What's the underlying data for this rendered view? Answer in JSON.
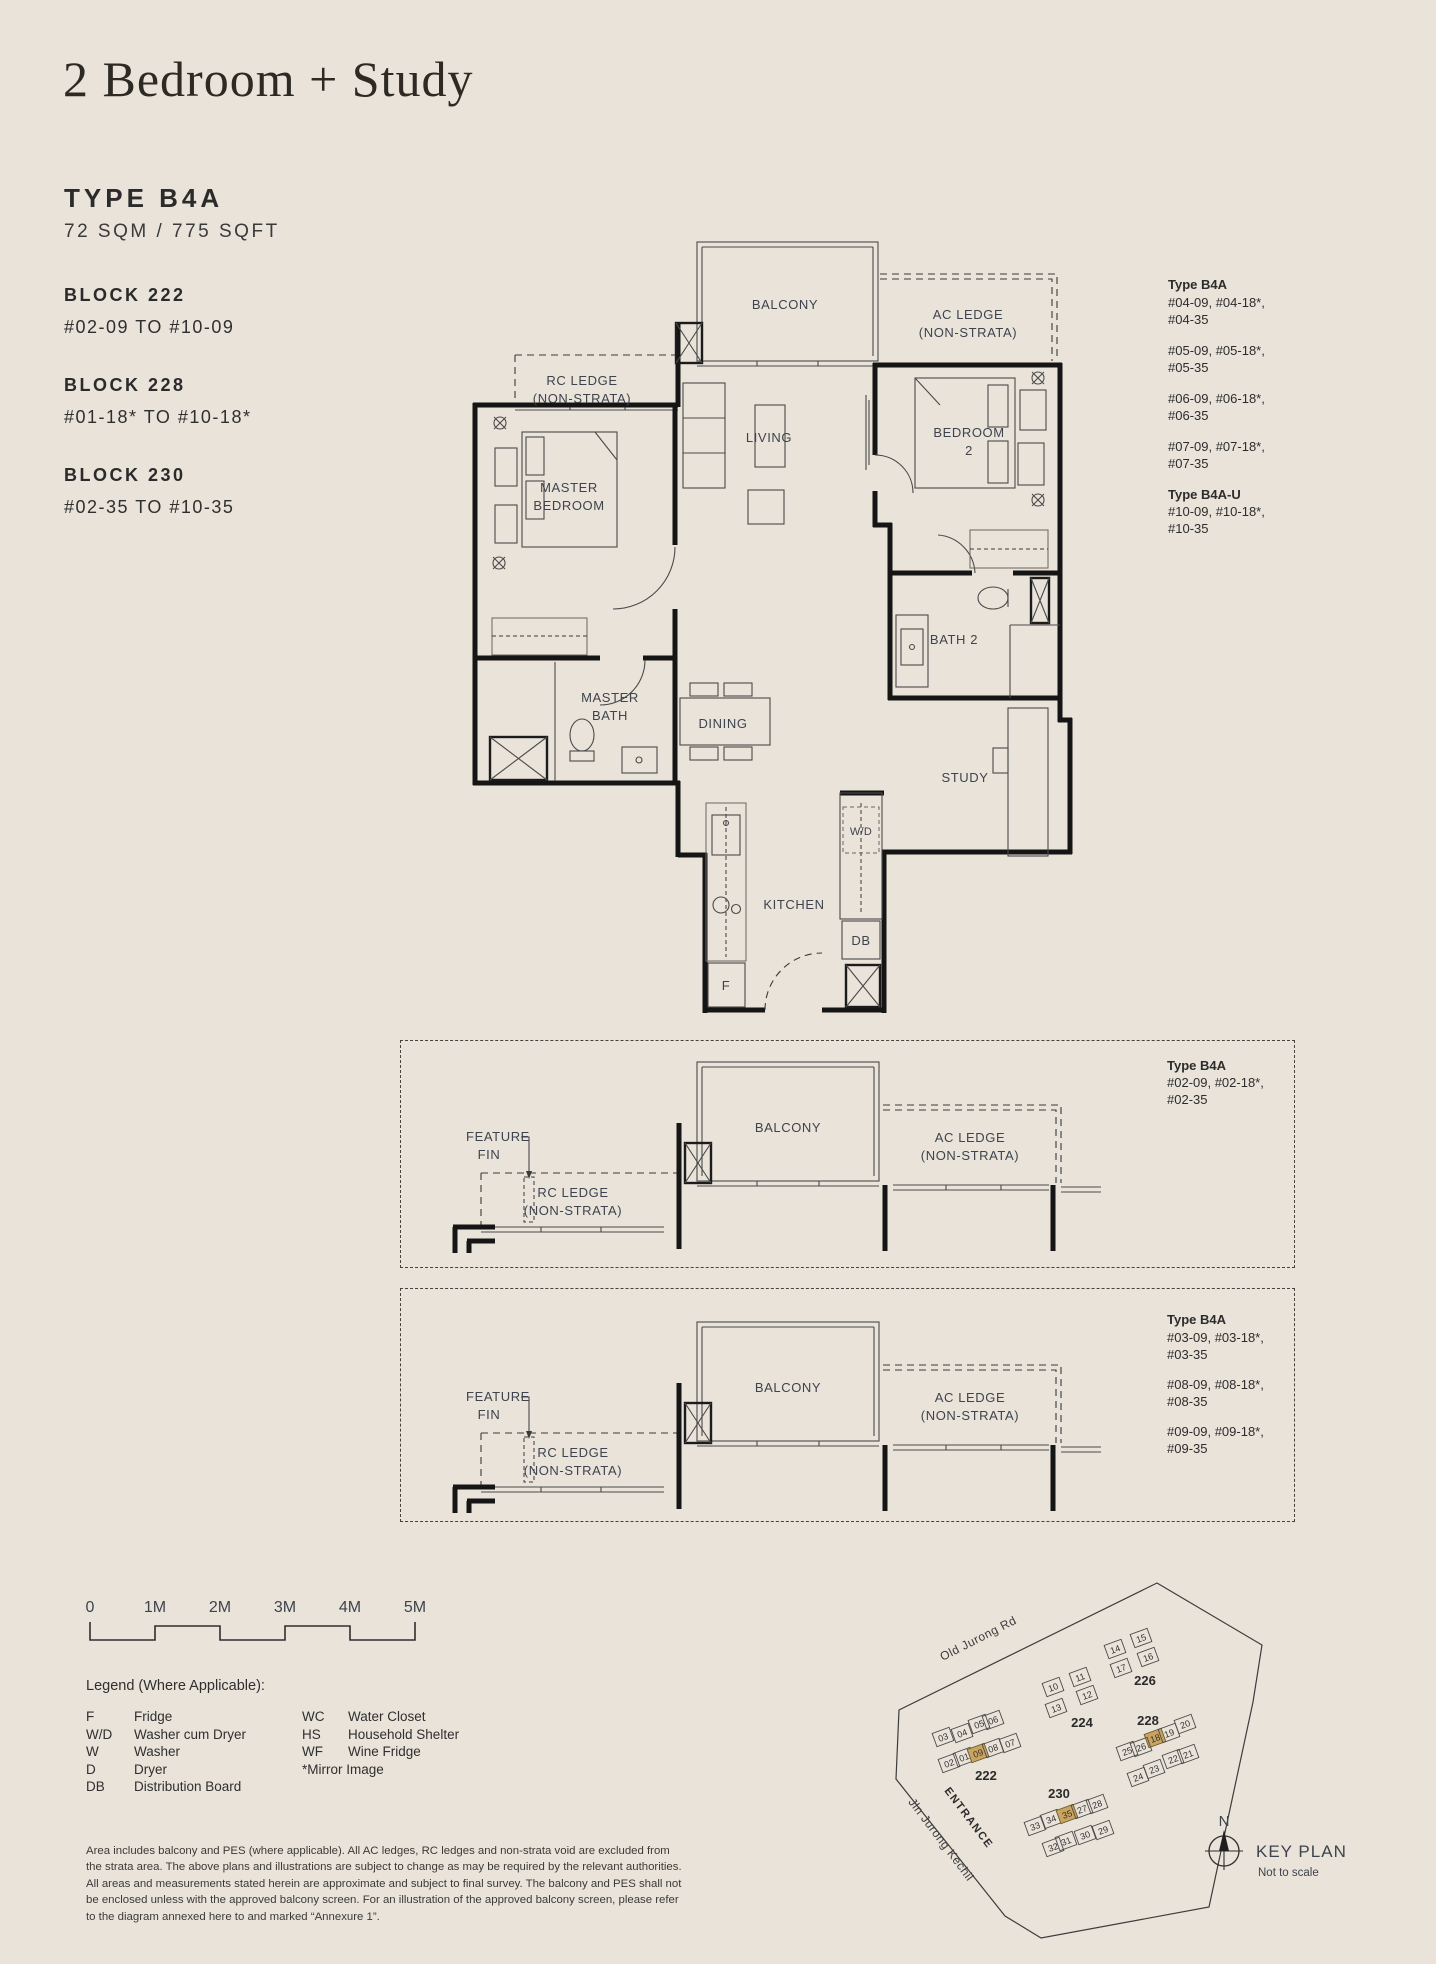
{
  "header": {
    "title": "2 Bedroom + Study",
    "type_label": "TYPE B4A",
    "area": "72 SQM / 775 SQFT",
    "blocks": [
      {
        "name": "BLOCK 222",
        "range": "#02-09 TO #10-09"
      },
      {
        "name": "BLOCK 228",
        "range": "#01-18* TO #10-18*"
      },
      {
        "name": "BLOCK 230",
        "range": "#02-35 TO #10-35"
      }
    ]
  },
  "plan": {
    "rooms": {
      "balcony": "BALCONY",
      "ac_ledge_1": "AC LEDGE",
      "ac_ledge_2": "(NON-STRATA)",
      "rc_ledge_1": "RC LEDGE",
      "rc_ledge_2": "(NON-STRATA)",
      "master_bedroom_1": "MASTER",
      "master_bedroom_2": "BEDROOM",
      "living": "LIVING",
      "bedroom2_1": "BEDROOM",
      "bedroom2_2": "2",
      "bath2": "BATH 2",
      "master_bath_1": "MASTER",
      "master_bath_2": "BATH",
      "dining": "DINING",
      "study": "STUDY",
      "kitchen": "KITCHEN",
      "wd": "W/D",
      "db": "DB",
      "fridge": "F"
    }
  },
  "stack_main": {
    "title1": "Type B4A",
    "groups": [
      [
        "#04-09, #04-18*,",
        "#04-35"
      ],
      [
        "#05-09, #05-18*,",
        "#05-35"
      ],
      [
        "#06-09, #06-18*,",
        "#06-35"
      ],
      [
        "#07-09, #07-18*,",
        "#07-35"
      ]
    ],
    "title2": "Type B4A-U",
    "group2": [
      "#10-09, #10-18*,",
      "#10-35"
    ]
  },
  "detail_labels": {
    "feature_fin_1": "FEATURE",
    "feature_fin_2": "FIN",
    "rc_1": "RC LEDGE",
    "rc_2": "(NON-STRATA)",
    "balcony": "BALCONY",
    "ac_1": "AC LEDGE",
    "ac_2": "(NON-STRATA)"
  },
  "detail1": {
    "title": "Type B4A",
    "groups": [
      [
        "#02-09, #02-18*,",
        "#02-35"
      ]
    ]
  },
  "detail2": {
    "title": "Type B4A",
    "groups": [
      [
        "#03-09, #03-18*,",
        "#03-35"
      ],
      [
        "#08-09, #08-18*,",
        "#08-35"
      ],
      [
        "#09-09, #09-18*,",
        "#09-35"
      ]
    ]
  },
  "scalebar": {
    "labels": [
      "0",
      "1M",
      "2M",
      "3M",
      "4M",
      "5M"
    ]
  },
  "legend": {
    "title": "Legend (Where Applicable):",
    "col1": [
      [
        "F",
        "Fridge"
      ],
      [
        "W/D",
        "Washer cum Dryer"
      ],
      [
        "W",
        "Washer"
      ],
      [
        "D",
        "Dryer"
      ],
      [
        "DB",
        "Distribution Board"
      ]
    ],
    "col2": [
      [
        "WC",
        "Water Closet"
      ],
      [
        "HS",
        "Household Shelter"
      ],
      [
        "WF",
        "Wine Fridge"
      ]
    ],
    "note": "*Mirror Image"
  },
  "disclaimer": {
    "line1": "Area includes balcony and PES (where applicable). All AC ledges, RC ledges and non-strata void are excluded from",
    "line2": "the strata area. The above plans and illustrations are subject to change as may be required by the relevant authorities.",
    "line3": "All areas and measurements stated herein are approximate and subject to final survey. The balcony and PES shall not",
    "line4": "be enclosed unless with the approved balcony screen. For an illustration of the approved balcony screen, please refer",
    "line5": "to the diagram annexed here to and marked “Annexure 1”."
  },
  "keyplan": {
    "title": "KEY PLAN",
    "subtitle": "Not to scale",
    "north": "N",
    "entrance": "ENTRANCE",
    "road1": "Old Jurong Rd",
    "road2": "Jln Jurong Kechil",
    "highlighted": [
      "09",
      "18",
      "35"
    ],
    "highlight_color": "#c9a45f",
    "clusters": [
      {
        "block": "222",
        "cells": [
          "03",
          "04",
          "05",
          "06",
          "02",
          "01",
          "09",
          "08",
          "07"
        ]
      },
      {
        "block": "224",
        "cells": [
          "10",
          "11",
          "12",
          "13"
        ]
      },
      {
        "block": "226",
        "cells": [
          "14",
          "15",
          "16",
          "17"
        ]
      },
      {
        "block": "228",
        "cells": [
          "18",
          "19",
          "20",
          "25",
          "26",
          "24",
          "23",
          "22",
          "21"
        ]
      },
      {
        "block": "230",
        "cells": [
          "33",
          "34",
          "35",
          "27",
          "28",
          "32",
          "31",
          "30",
          "29"
        ]
      }
    ]
  }
}
